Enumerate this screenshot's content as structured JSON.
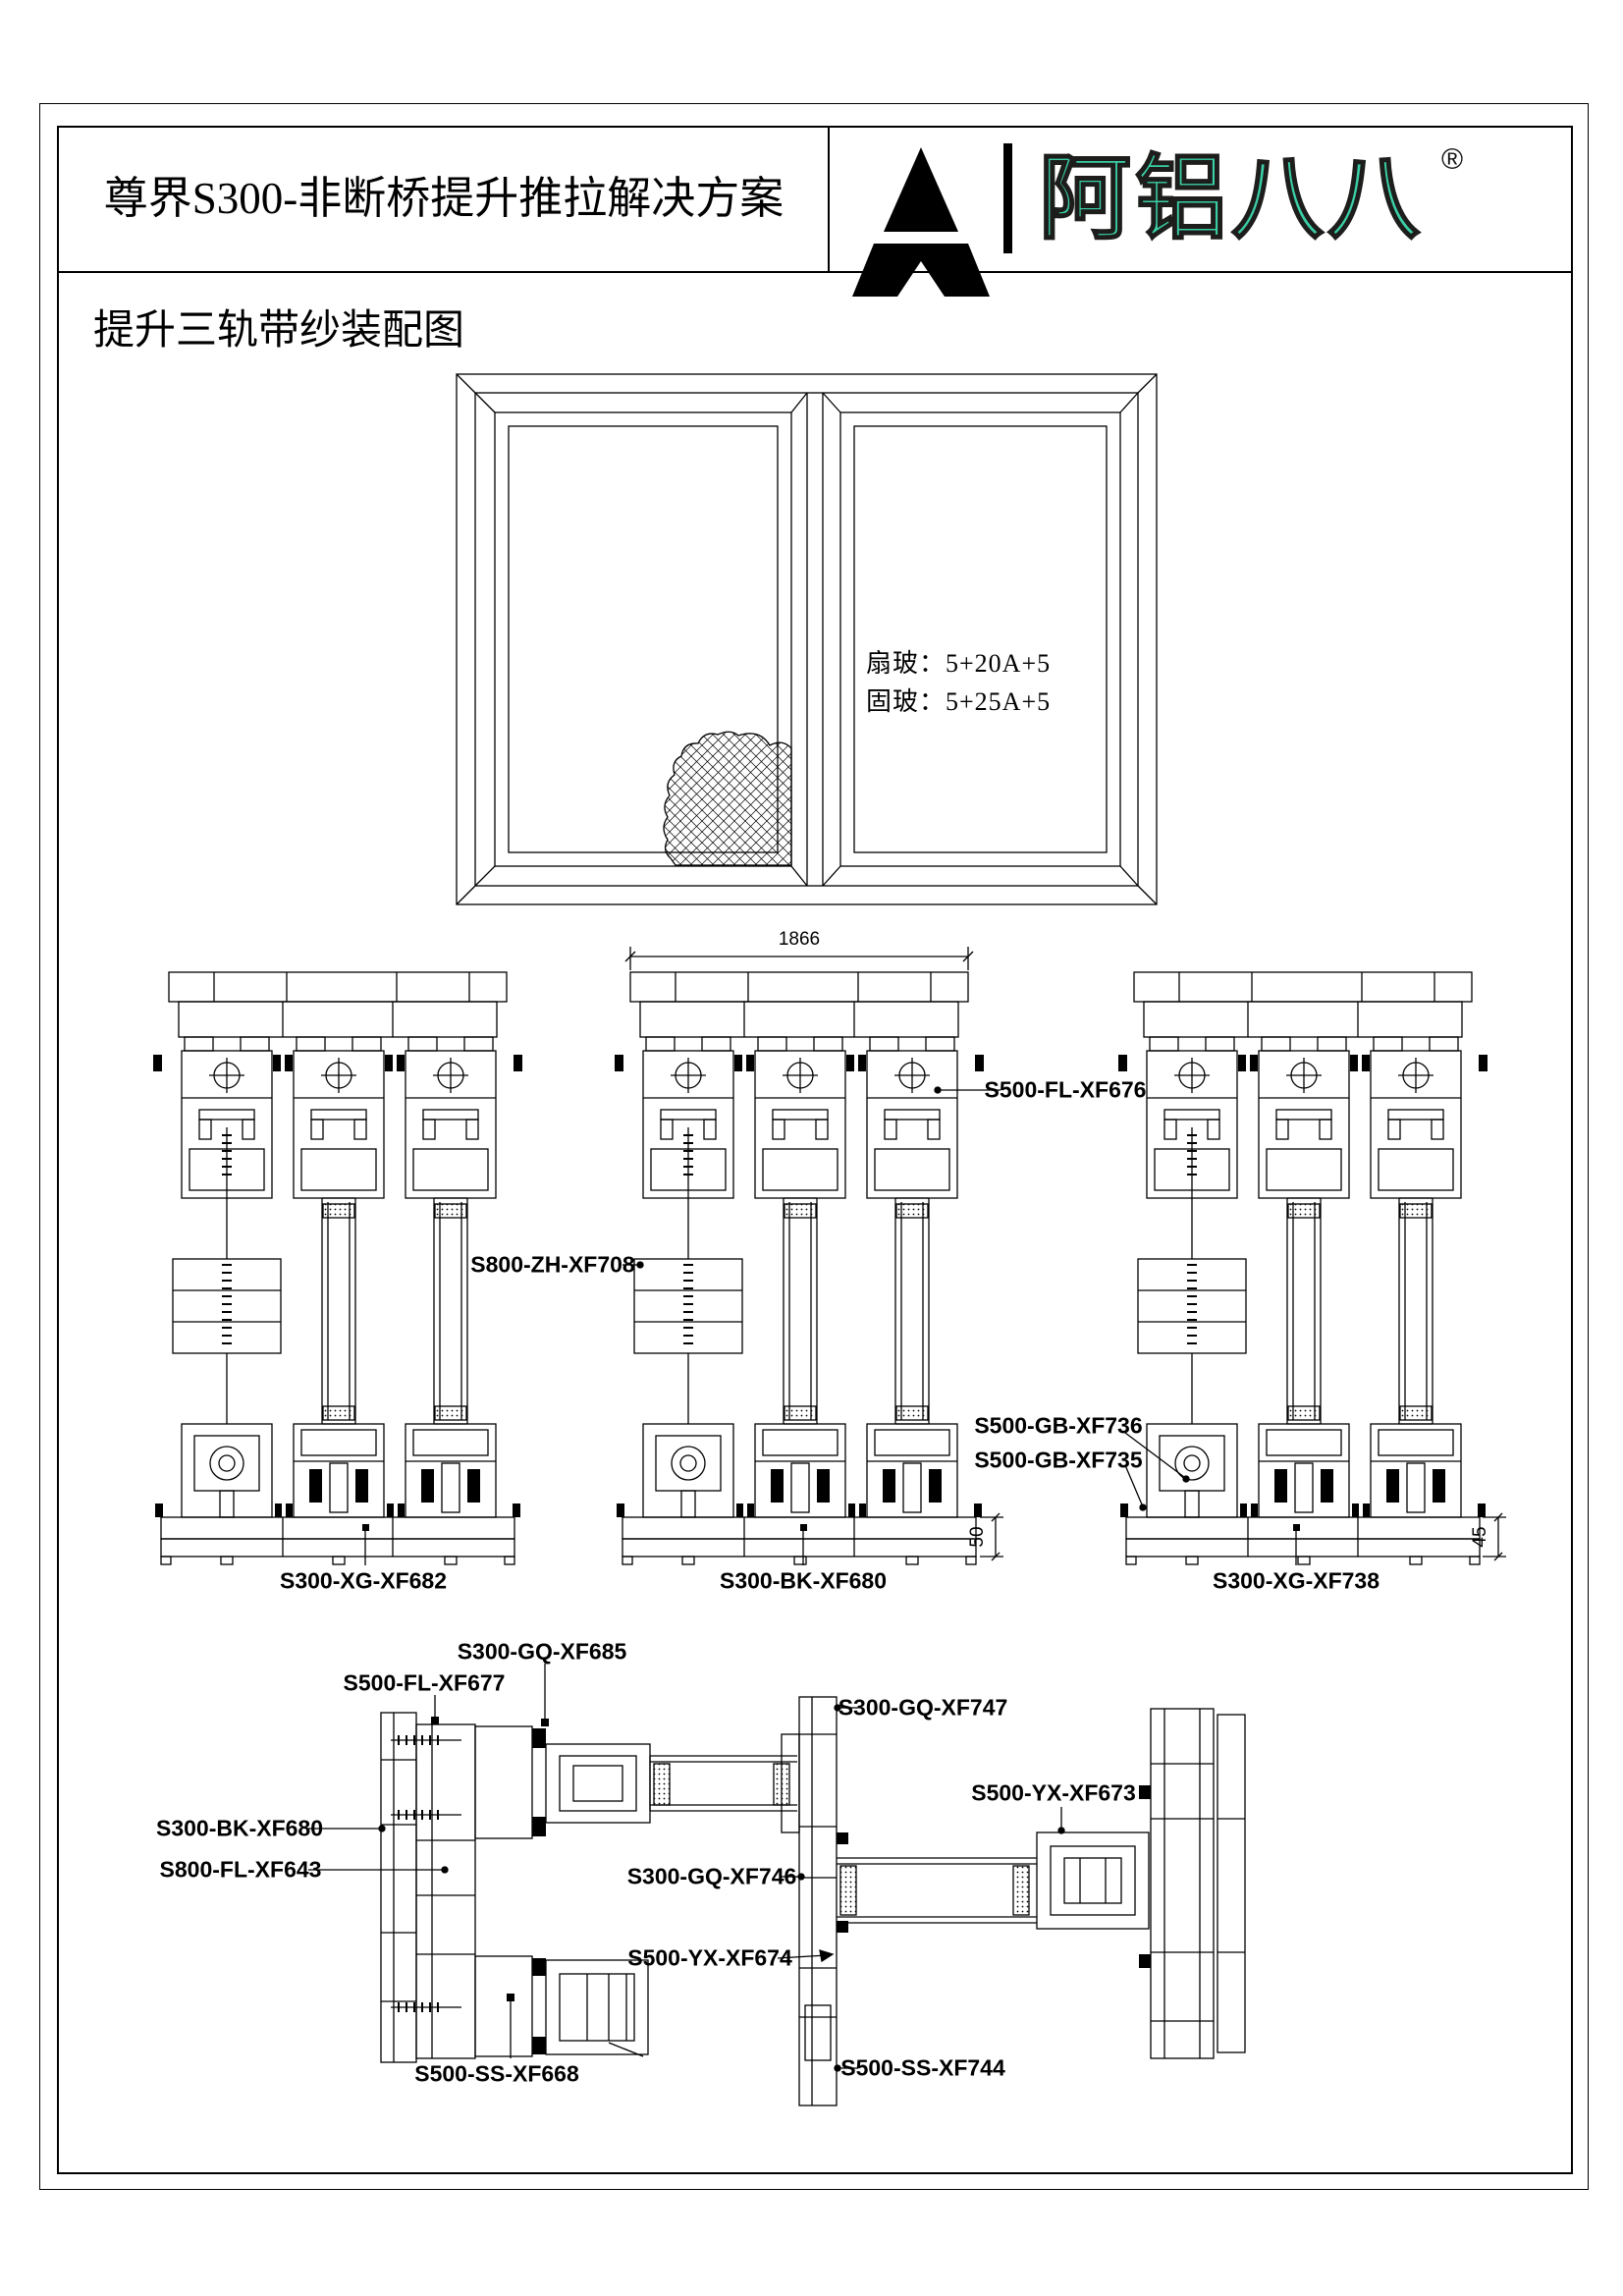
{
  "page": {
    "title": "尊界S300-非断桥提升推拉解决方案",
    "subtitle": "提升三轨带纱装配图"
  },
  "logo": {
    "brand_text": "阿铝八八",
    "registered_mark": "®",
    "mark_icon": "triangle-mountain-logo",
    "teal": "#3BCFA6"
  },
  "elevation": {
    "sash_glass_note": "扇玻：5+20A+5",
    "fixed_glass_note": "固玻：5+25A+5"
  },
  "dims": {
    "width_1866": "1866",
    "sill_height_50": "50",
    "sill_height_45": "45"
  },
  "labels": {
    "s500_fl_xf676": "S500-FL-XF676",
    "s800_zh_xf708": "S800-ZH-XF708",
    "s500_gb_xf736": "S500-GB-XF736",
    "s500_gb_xf735": "S500-GB-XF735",
    "s300_xg_xf682": "S300-XG-XF682",
    "s300_bk_xf680": "S300-BK-XF680",
    "s300_xg_xf738": "S300-XG-XF738",
    "s300_gq_xf685": "S300-GQ-XF685",
    "s500_fl_xf677": "S500-FL-XF677",
    "s300_bk_xf680_plan": "S300-BK-XF680",
    "s800_fl_xf643": "S800-FL-XF643",
    "s500_ss_xf668": "S500-SS-XF668",
    "s300_gq_xf747": "S300-GQ-XF747",
    "s500_yx_xf673": "S500-YX-XF673",
    "s300_gq_xf746": "S300-GQ-XF746",
    "s500_yx_xf674": "S500-YX-XF674",
    "s500_ss_xf744": "S500-SS-XF744"
  },
  "colors": {
    "line": "#000000",
    "background": "#ffffff",
    "logo_teal": "#3BCFA6"
  }
}
